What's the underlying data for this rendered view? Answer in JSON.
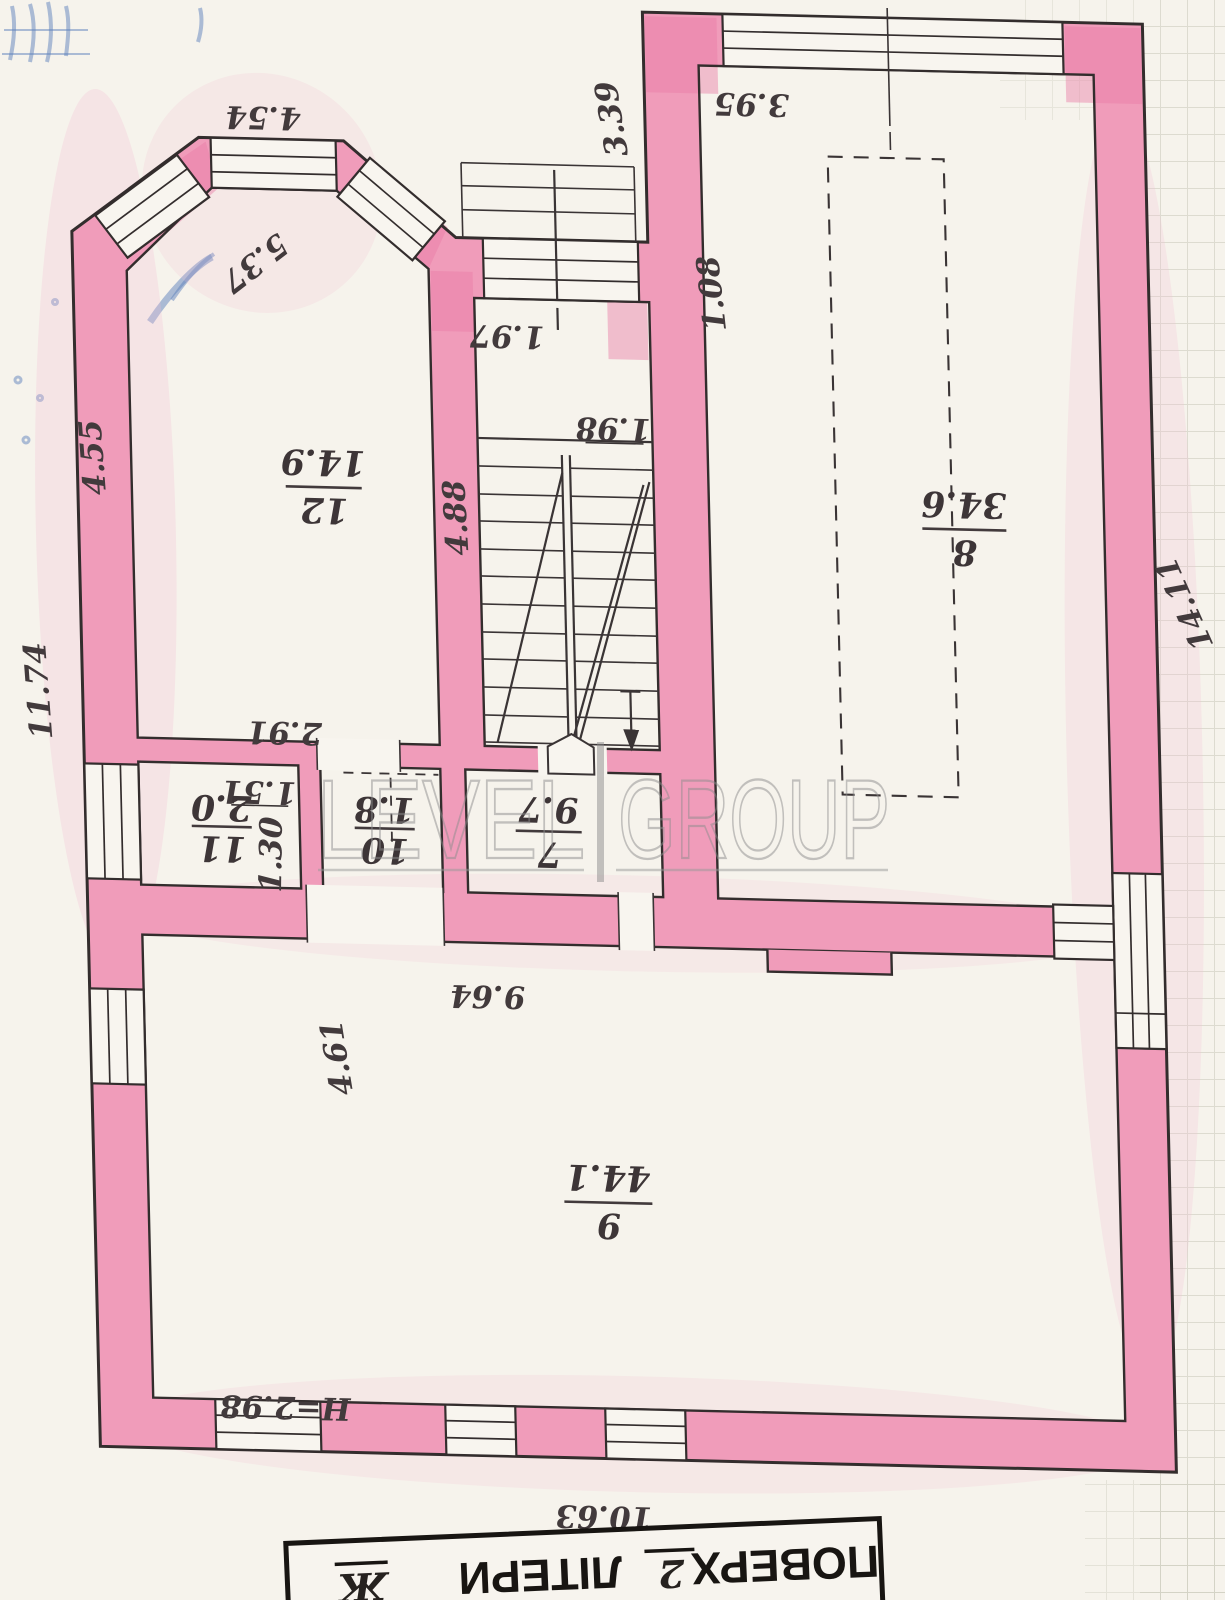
{
  "document": {
    "type": "floor-plan-scan",
    "orientation": "rotated-180",
    "wall_color": "#f09cba",
    "paper_color": "#f6f3ec"
  },
  "watermark": {
    "word1": "LEVEL",
    "word2": "GROUP"
  },
  "title_block": {
    "floor_label": "ПОВЕРХ",
    "floor_value": "2",
    "letter_label": "ЛІТЕРИ",
    "letter_value": "Ж"
  },
  "rooms": {
    "r12": {
      "number": "12",
      "area": "14.9"
    },
    "r8": {
      "number": "8",
      "area": "34.6"
    },
    "r7": {
      "number": "7",
      "area": "9.7"
    },
    "r11": {
      "number": "11",
      "area": "2.0"
    },
    "r10": {
      "number": "10",
      "area": "1.8"
    },
    "r9": {
      "number": "9",
      "area": "44.1"
    }
  },
  "dims": {
    "bay_top": "4.54",
    "bay_diag": "5.37",
    "room12_left": "4.55",
    "outer_left": "11.74",
    "corridor": "2.91",
    "wc_width": "1.51",
    "wc_depth": "1.30",
    "stair_window": "1.97",
    "landing": "1.98",
    "stair_length": "4.88",
    "porch_side": "3.39",
    "door8": "1.08",
    "room8_top": "3.95",
    "outer_right": "14.11",
    "room9_top": "9.64",
    "room9_left": "4.61",
    "ceiling_height": "H=2.98",
    "room9_bottom": "10.63"
  }
}
